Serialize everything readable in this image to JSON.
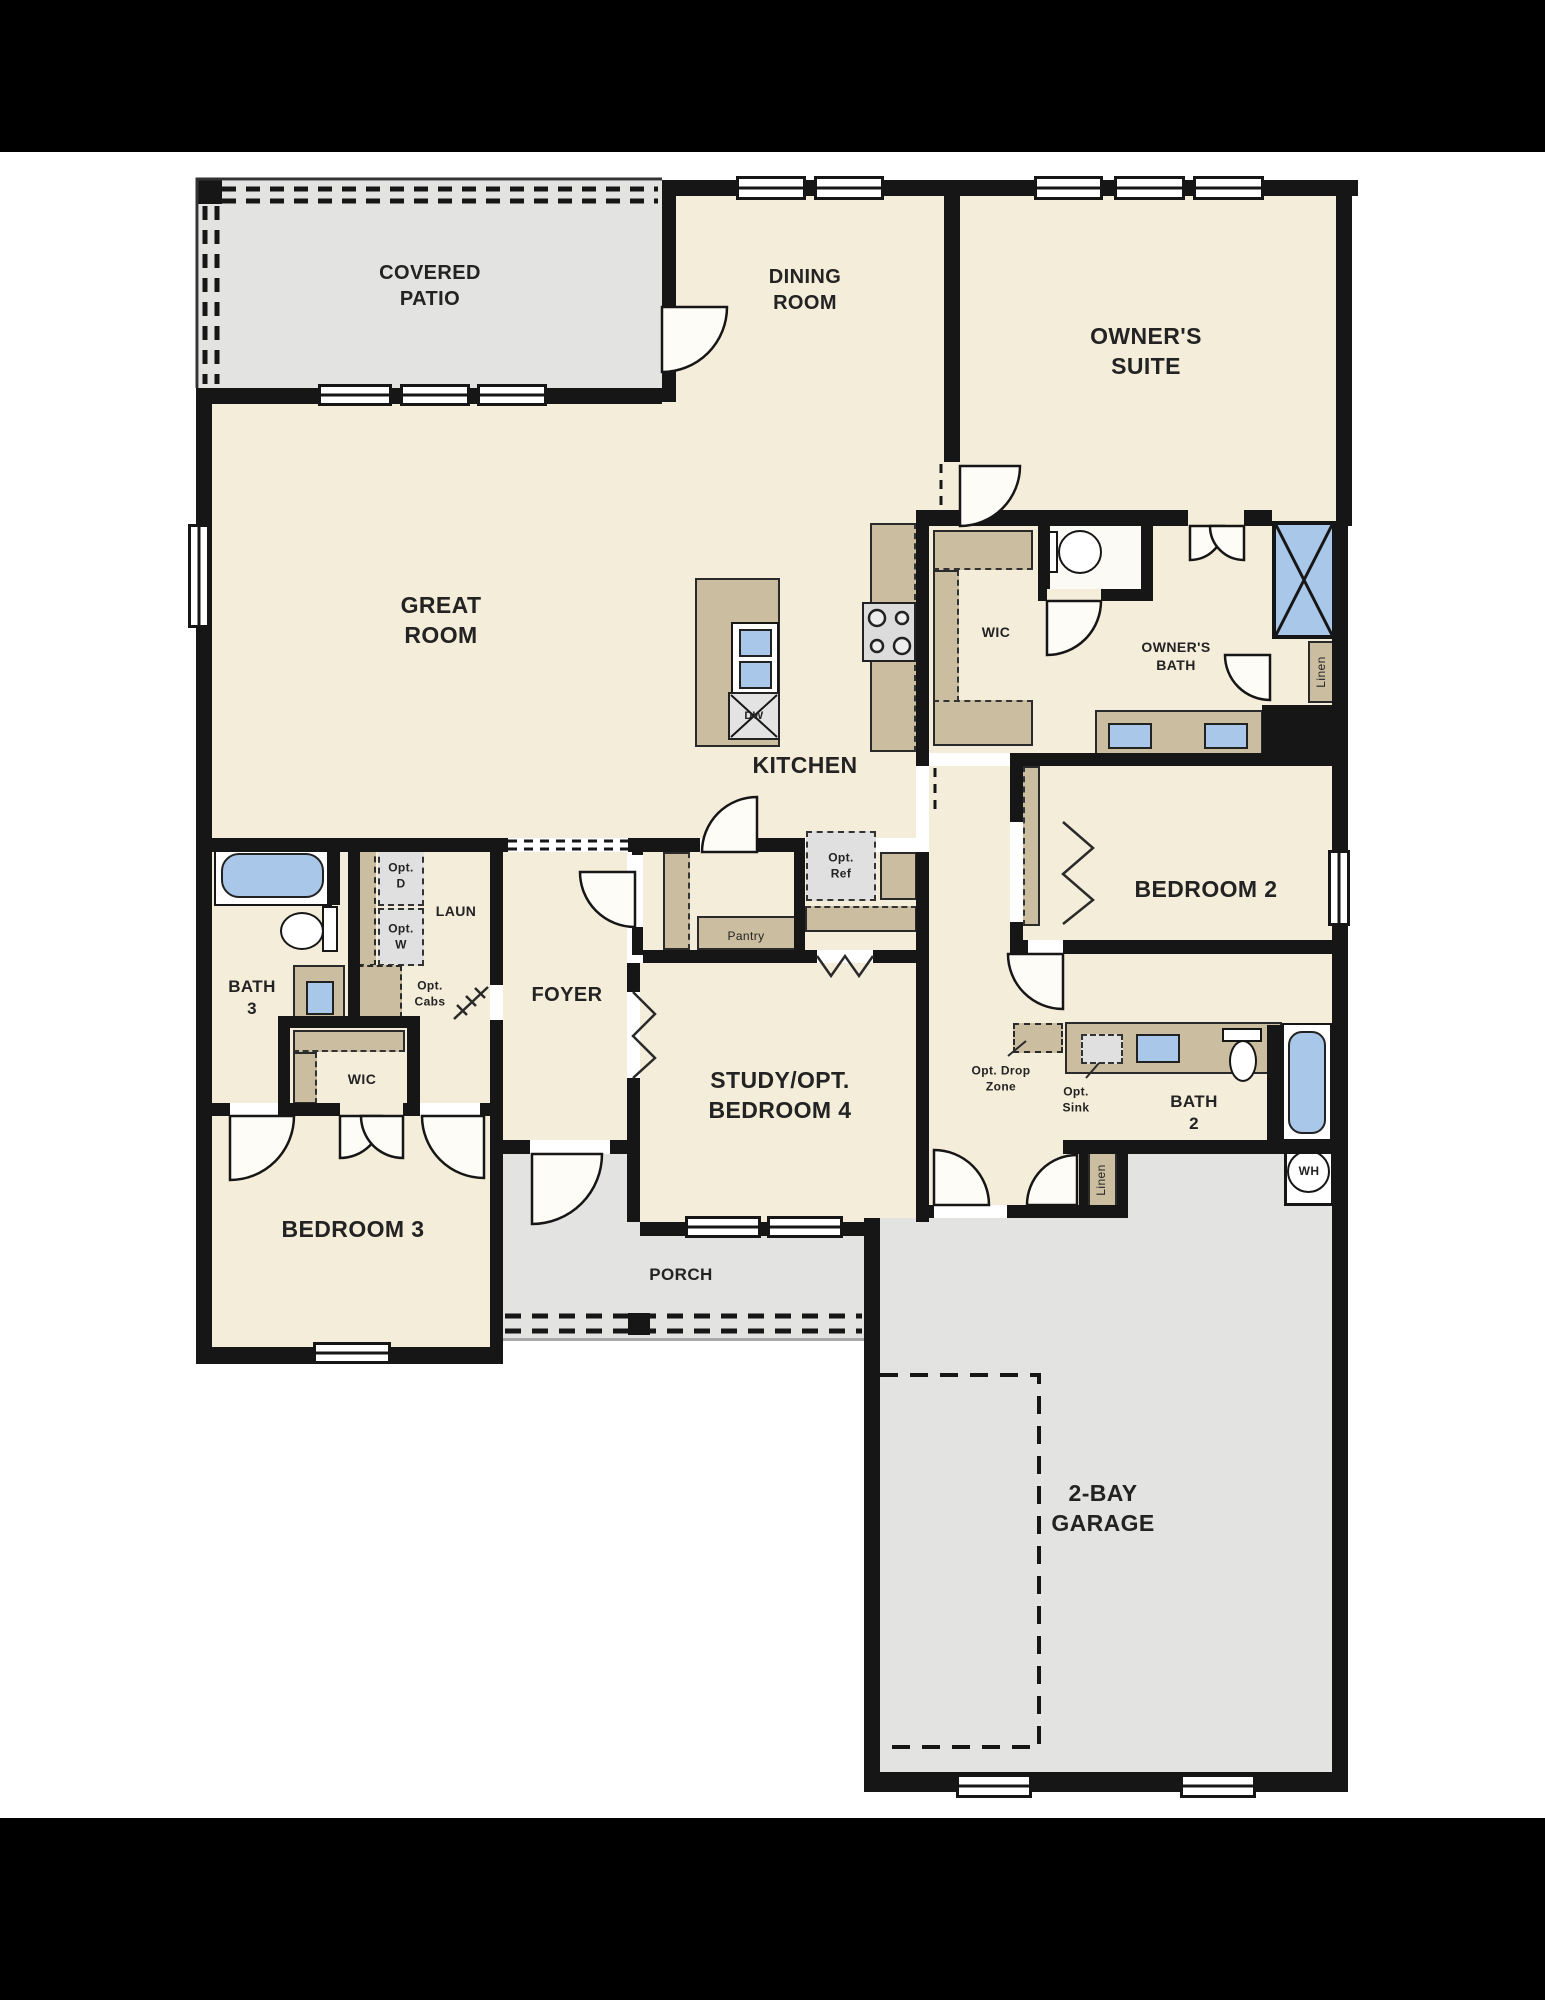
{
  "document": {
    "type": "single-story floor plan"
  },
  "colors": {
    "wall": "#161616",
    "room_fill": "#f4edda",
    "outdoor_fill": "#e3e3e1",
    "cabinet_fill": "#cbbda0",
    "fixture_blue": "#a9c7e8",
    "optional_gray": "#e0e0e0",
    "background_bars": "#000000"
  },
  "labels": {
    "covered_patio": "COVERED\nPATIO",
    "dining": "DINING\nROOM",
    "owners_suite": "OWNER'S\nSUITE",
    "great_room": "GREAT\nROOM",
    "kitchen": "KITCHEN",
    "wic_owner": "WIC",
    "owners_bath": "OWNER'S\nBATH",
    "linen1": "Linen",
    "bedroom2": "BEDROOM 2",
    "bath2": "BATH\n2",
    "opt_sink": "Opt.\nSink",
    "opt_drop": "Opt. Drop\nZone",
    "wh": "WH",
    "bath3": "BATH\n3",
    "laun": "LAUN",
    "opt_d": "Opt.\nD",
    "opt_w": "Opt.\nW",
    "opt_cabs": "Opt.\nCabs",
    "foyer": "FOYER",
    "pantry": "Pantry",
    "opt_ref": "Opt.\nRef",
    "study": "STUDY/OPT.\nBEDROOM 4",
    "wic_bed3": "WIC",
    "bedroom3": "BEDROOM 3",
    "porch": "PORCH",
    "garage": "2-BAY\nGARAGE",
    "dw": "DW"
  }
}
